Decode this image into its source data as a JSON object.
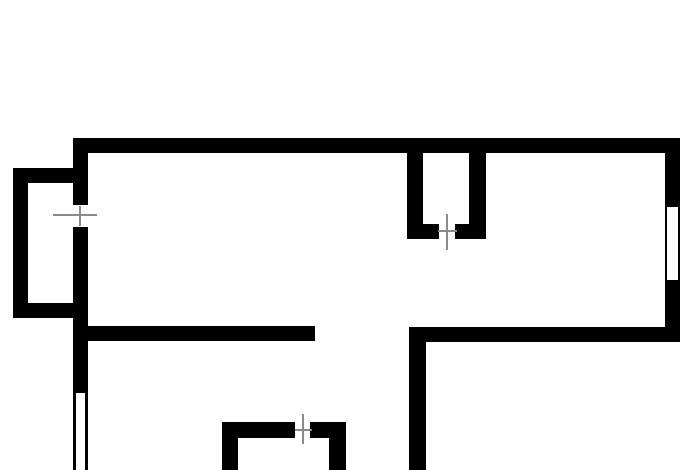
{
  "canvas": {
    "width": 700,
    "height": 470,
    "background": "#ffffff"
  },
  "colors": {
    "wall": "#000000",
    "window": "#ffffff",
    "door-marker": "#8a8a8a"
  },
  "floor_plan": {
    "elements": [
      {
        "name": "top-wall",
        "type": "wall",
        "x": 73,
        "y": 138,
        "w": 607,
        "h": 15
      },
      {
        "name": "right-wall",
        "type": "wall",
        "x": 665,
        "y": 138,
        "w": 15,
        "h": 204
      },
      {
        "name": "left-wall-upper",
        "type": "wall",
        "x": 73,
        "y": 138,
        "w": 15,
        "h": 67
      },
      {
        "name": "left-wall-lower",
        "type": "wall",
        "x": 73,
        "y": 227,
        "w": 15,
        "h": 166
      },
      {
        "name": "balcony-top-wall",
        "type": "wall",
        "x": 13,
        "y": 168,
        "w": 60,
        "h": 15
      },
      {
        "name": "balcony-left-wall",
        "type": "wall",
        "x": 13,
        "y": 168,
        "w": 15,
        "h": 150
      },
      {
        "name": "balcony-bottom-wall",
        "type": "wall",
        "x": 13,
        "y": 303,
        "w": 60,
        "h": 15
      },
      {
        "name": "closet-left-wall",
        "type": "wall",
        "x": 407,
        "y": 153,
        "w": 16,
        "h": 86
      },
      {
        "name": "closet-right-wall",
        "type": "wall",
        "x": 469,
        "y": 153,
        "w": 17,
        "h": 86
      },
      {
        "name": "closet-bottom-left-stub",
        "type": "wall",
        "x": 423,
        "y": 224,
        "w": 16,
        "h": 15
      },
      {
        "name": "closet-bottom-right-stub",
        "type": "wall",
        "x": 455,
        "y": 224,
        "w": 14,
        "h": 15
      },
      {
        "name": "mid-left-partition-wall",
        "type": "wall",
        "x": 73,
        "y": 326,
        "w": 242,
        "h": 15
      },
      {
        "name": "mid-right-partition-wall",
        "type": "wall",
        "x": 409,
        "y": 327,
        "w": 271,
        "h": 15
      },
      {
        "name": "lower-vertical-wall",
        "type": "wall",
        "x": 409,
        "y": 327,
        "w": 17,
        "h": 143
      },
      {
        "name": "small-room-top-wall-left",
        "type": "wall",
        "x": 222,
        "y": 422,
        "w": 73,
        "h": 16
      },
      {
        "name": "small-room-top-wall-right",
        "type": "wall",
        "x": 310,
        "y": 422,
        "w": 36,
        "h": 16
      },
      {
        "name": "small-room-left-wall",
        "type": "wall",
        "x": 222,
        "y": 422,
        "w": 16,
        "h": 48
      },
      {
        "name": "small-room-right-wall",
        "type": "wall",
        "x": 329,
        "y": 438,
        "w": 17,
        "h": 32
      },
      {
        "name": "left-window-left-edge",
        "type": "wall",
        "x": 73,
        "y": 393,
        "w": 3,
        "h": 77
      },
      {
        "name": "left-window-right-edge",
        "type": "wall",
        "x": 85,
        "y": 393,
        "w": 3,
        "h": 77
      },
      {
        "name": "right-wall-window",
        "type": "window",
        "x": 667,
        "y": 207,
        "w": 11,
        "h": 73
      },
      {
        "name": "balcony-door-marker-horizontal",
        "type": "door-marker",
        "x": 53,
        "y": 214,
        "w": 44,
        "h": 2
      },
      {
        "name": "balcony-door-marker-vertical",
        "type": "door-marker",
        "x": 79,
        "y": 206,
        "w": 2,
        "h": 20
      },
      {
        "name": "closet-door-marker-vertical",
        "type": "door-marker",
        "x": 446,
        "y": 214,
        "w": 2,
        "h": 36
      },
      {
        "name": "closet-door-marker-horizontal",
        "type": "door-marker",
        "x": 438,
        "y": 230,
        "w": 19,
        "h": 2
      },
      {
        "name": "small-room-door-marker-vertical",
        "type": "door-marker",
        "x": 302,
        "y": 414,
        "w": 2,
        "h": 30
      },
      {
        "name": "small-room-door-marker-horizontal",
        "type": "door-marker",
        "x": 295,
        "y": 429,
        "w": 17,
        "h": 2
      }
    ]
  }
}
